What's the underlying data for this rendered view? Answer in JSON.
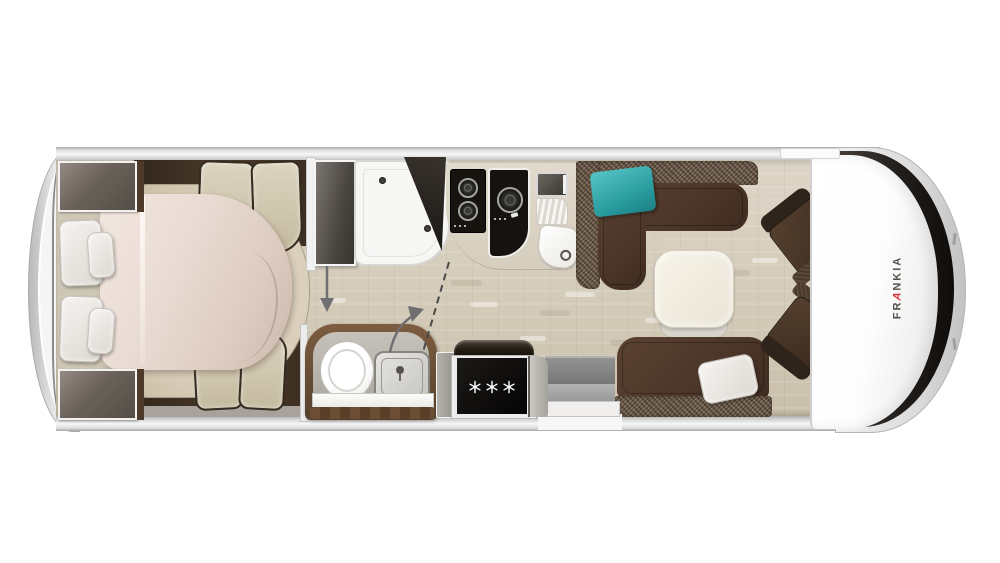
{
  "title": "Frankia motorhome floor plan - top view",
  "brand": {
    "full_name": "FRANKIA",
    "wordmark_prefix": "FR",
    "wordmark_accent_letter": "A",
    "wordmark_suffix": "NKIA",
    "letter_color": "#57514b",
    "accent_color": "#e0313a"
  },
  "appliances": {
    "fridge": {
      "snowflake_icon_count": 3
    },
    "cooktop_left_burners": 2,
    "cooktop_right_burners": 1
  },
  "palette": {
    "background": "#ffffff",
    "shell_silver": "#e3e3e3",
    "floor_beige": "#d7cfbf",
    "bedroom_dark_wood": "#473729",
    "cushion_beige": "#d2c9b4",
    "duvet_cream": "#e8dad2",
    "sofa_leather_brown": "#4f392b",
    "sofa_tweed_brown": "#6a594a",
    "pillow_teal": "#2aa2a6",
    "pillow_white": "#f1f0ee",
    "table_cream": "#f3efe4",
    "cooktop_black": "#15120f",
    "fridge_black": "#0c0b0a",
    "windshield_black": "#26221f",
    "step_gray": "#9a9a9a",
    "bath_wood": "#6b4e36"
  },
  "elements": [
    "rear-wardrobe-top",
    "rear-wardrobe-bottom",
    "island-bed",
    "bed-duvet",
    "bed-pillows",
    "bedside-benches",
    "shower-tray",
    "shower-door",
    "shower-corner-cabinet",
    "gas-cooktop-two-burner",
    "gas-cooktop-single-burner",
    "kitchen-appliance",
    "drainboard",
    "kitchen-sink",
    "l-shaped-sofa",
    "teal-cushion",
    "dinette-table",
    "bench-sofa",
    "white-pillow",
    "entry-steps",
    "toilet",
    "washbasin",
    "bathroom-vanity",
    "refrigerator",
    "cab-seat-upper",
    "cab-seat-lower",
    "cab-roof",
    "windshield",
    "frankia-wordmark",
    "entry-arrow",
    "door-swing-line"
  ]
}
